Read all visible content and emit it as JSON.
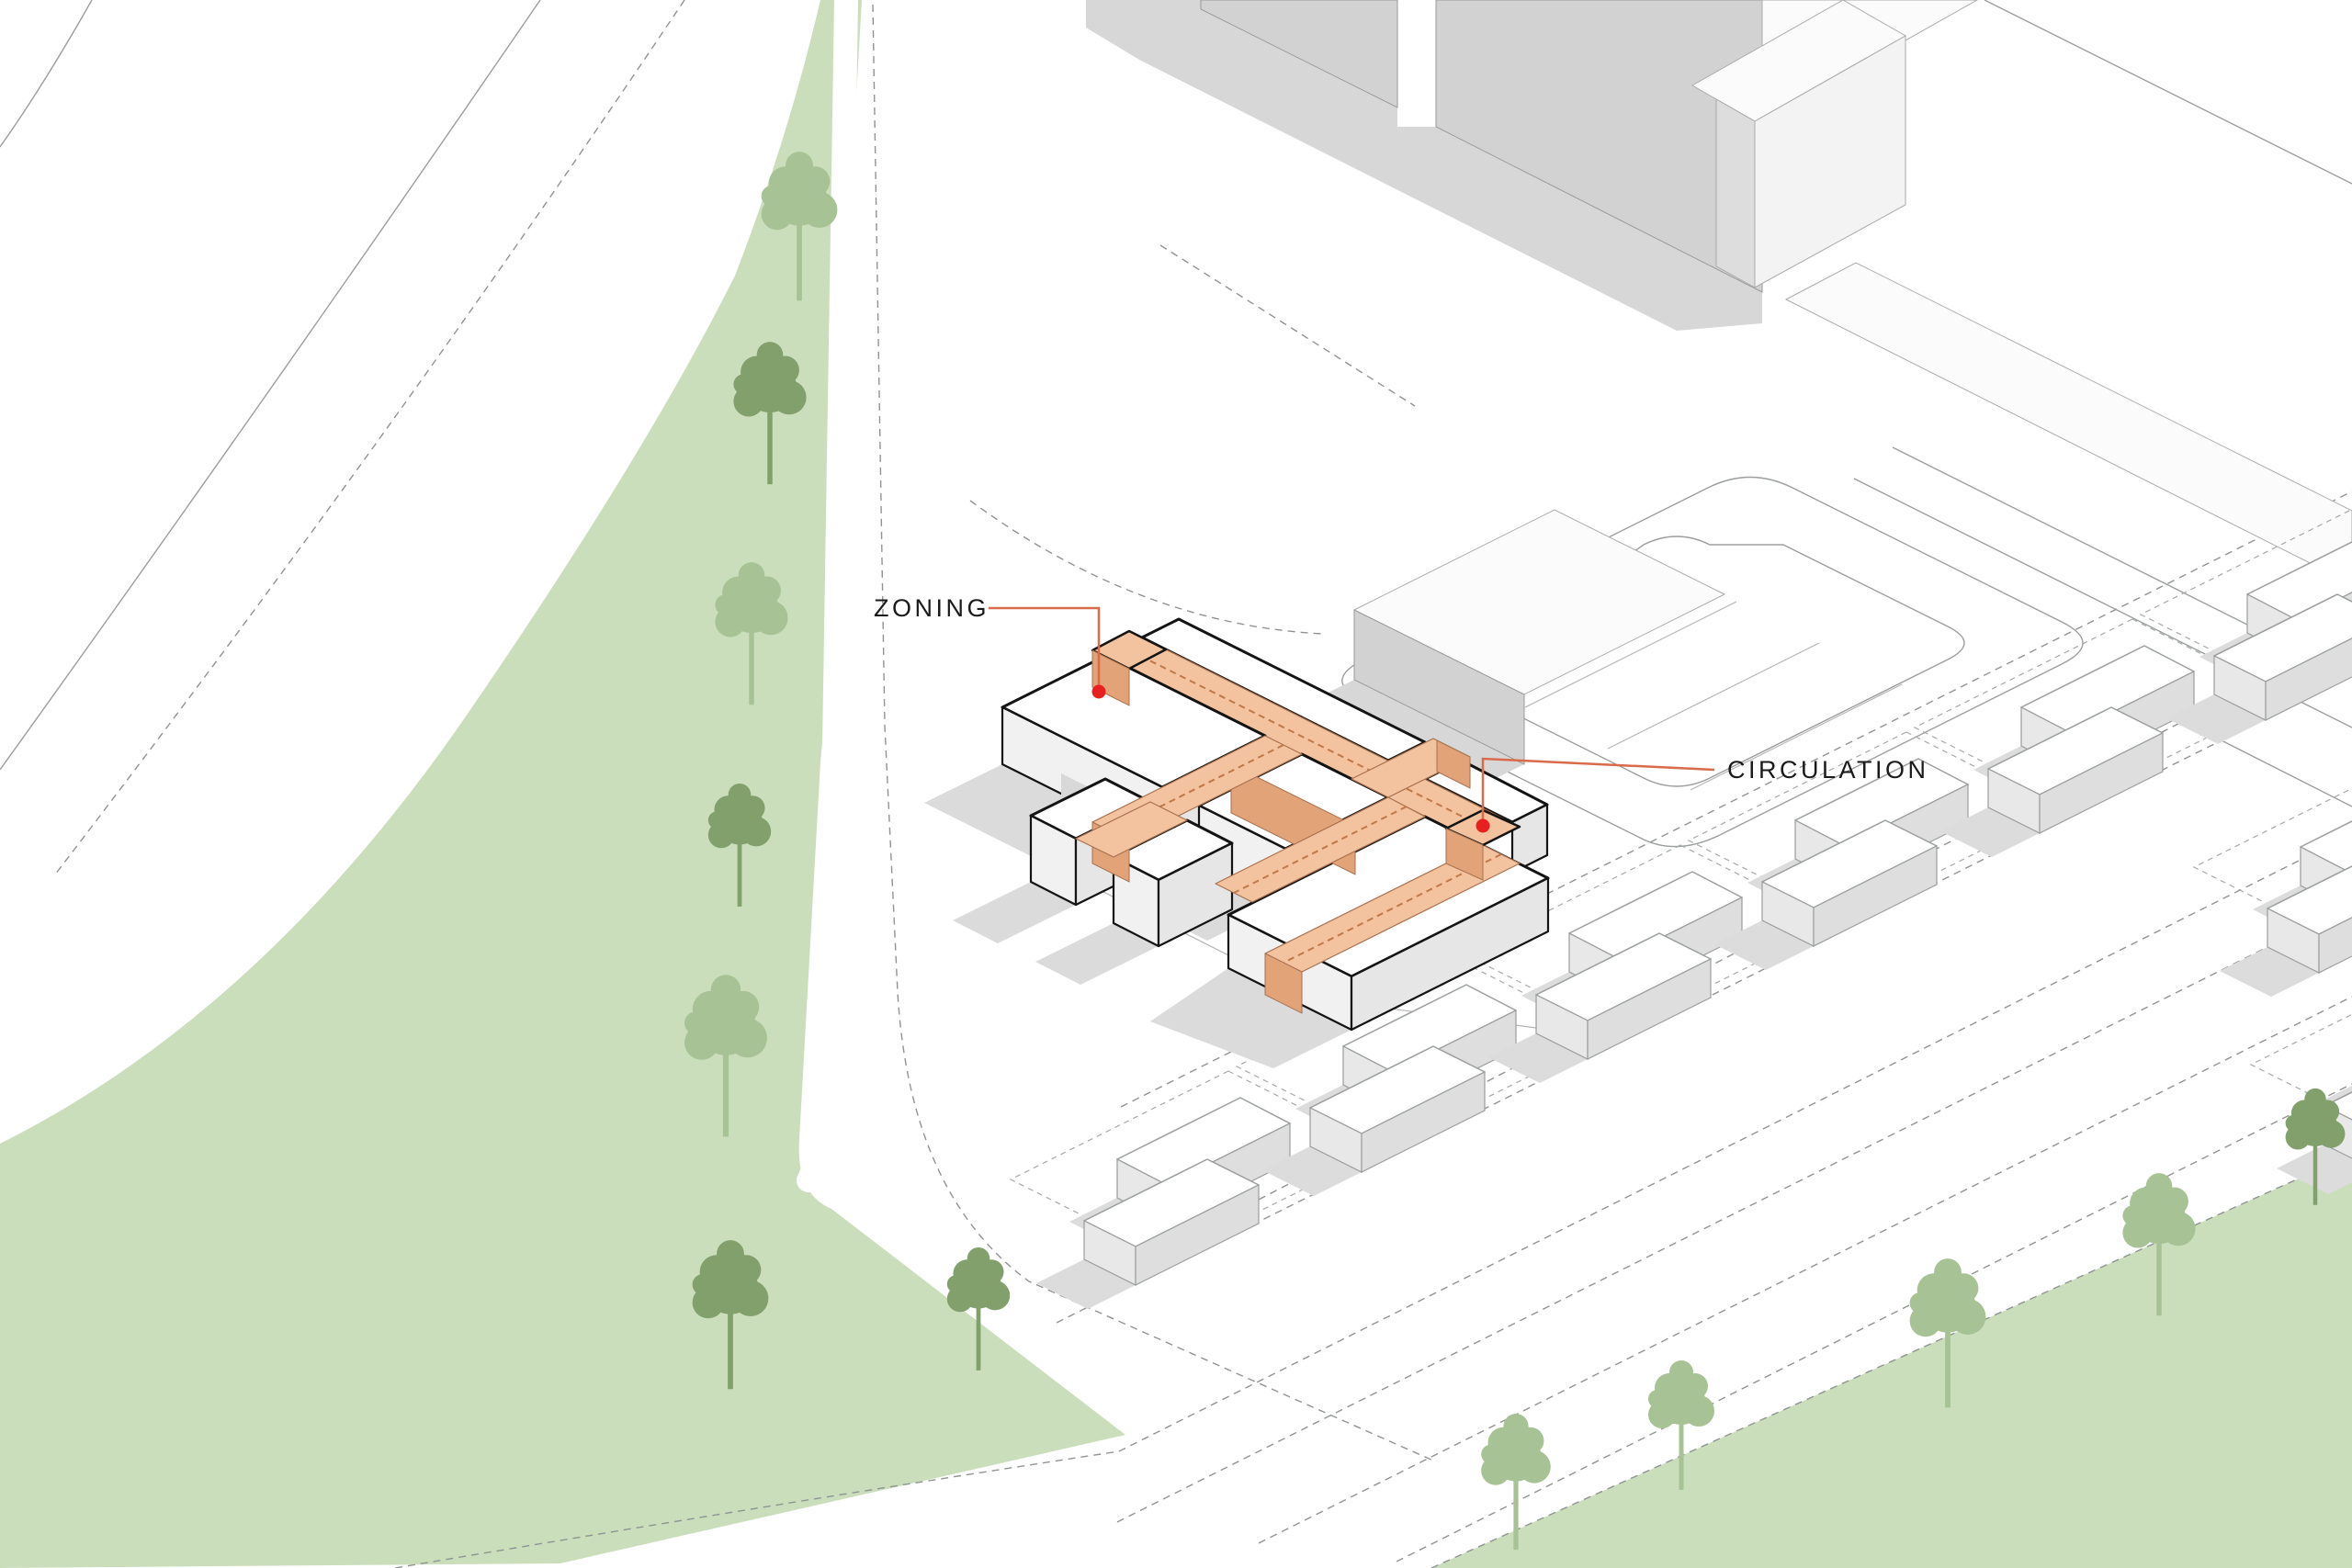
{
  "diagram": {
    "labels": {
      "zoning": "ZONING",
      "circulation": "CIRCULATION"
    },
    "colors": {
      "background": "#FFFFFF",
      "greenspace": "#CADEBB",
      "tree_dark": "#81A06C",
      "tree_light": "#A7C295",
      "subject_roof_white": "#FFFFFF",
      "subject_outline": "#141414",
      "circulation_top": "#F3C29F",
      "circulation_side": "#E2A379",
      "leader_line": "#D96A4A",
      "marker_red": "#E8201F",
      "context_gray": "#D2D2D2",
      "shadow_gray": "#DBDBDB",
      "line_gray": "#9A9E9C"
    }
  }
}
